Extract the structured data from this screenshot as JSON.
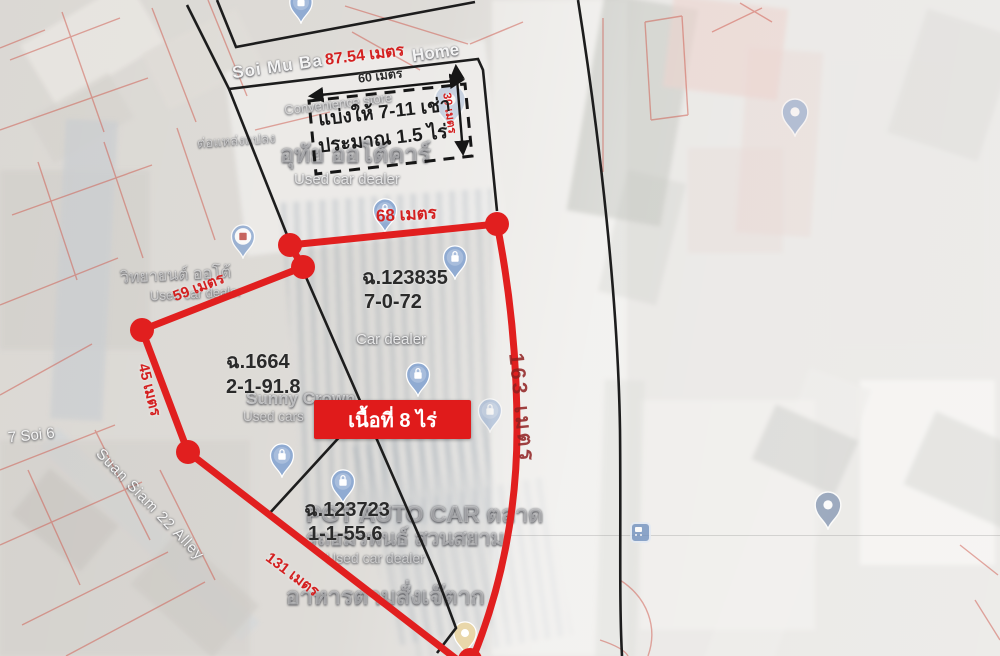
{
  "colors": {
    "annotation_red": "#e01b1b",
    "measure_red": "#d42020",
    "dark_red_road_label": "#8f2020",
    "line_black": "#1d1d1d",
    "pin_blue": "#90abd2",
    "pin_gray_blue": "#7d8fae",
    "pin_tan": "#e9d7aa"
  },
  "measurements": {
    "top_street_width": "87.54 เมตร",
    "inner_width": "60 เมตร",
    "inner_depth": "30 เมตร",
    "north_edge": "68 เมตร",
    "northwest_edge": "59 เมตร",
    "west_edge": "45 เมตร",
    "south_edge": "131 เมตร",
    "east_edge": "163 เมตร"
  },
  "notes": {
    "seven_eleven_line1": "แบ่งให้ 7-11 เช่า",
    "seven_eleven_line2": "ประมาณ 1.5 ไร่",
    "total_area": "เนื้อที่ 8 ไร่"
  },
  "parcels": [
    {
      "deed": "ฉ.123835",
      "size": "7-0-72"
    },
    {
      "deed": "ฉ.1664",
      "size": "2-1-91.8"
    },
    {
      "deed": "ฉ.123723",
      "size": "1-1-55.6"
    }
  ],
  "map_labels": {
    "street_main_left": "Soi Mu Ba",
    "street_main_right": "Home",
    "convenience_store": "Convenience store",
    "dealer_top_thai": "อุทัย ออโต้คาร์",
    "dealer_top": "Used car dealer",
    "plot_note_upper_left": "ต่อแหล่งแปลง",
    "dealer_left_thai": "วิทยายนต์ ออโต้",
    "dealer_left": "Used car dealer",
    "car_dealer_mid": "Car dealer",
    "sunny_name": "Sunny Crown",
    "sunny_sub": "Used cars",
    "pg_auto": "PGT AUTO CAR ตลาด",
    "amornpan": "รถอมรพนธ์ สวนสยาม",
    "dealer_bottom": "Used car dealer",
    "food_shop": "อาหารตามสั่งเจ๊ตาก",
    "soi_6": "7 Soi 6",
    "alley": "Suan Siam 22 Alley"
  },
  "icons": {
    "shopping_pin": "teardrop with shopping-bag glyph",
    "place_pin": "plain teardrop with white dot",
    "restaurant_pin": "tan teardrop with white dot",
    "bus_stop": "blue rounded square with bus glyph",
    "store_pin_red_logo": "teardrop with red store logo"
  }
}
